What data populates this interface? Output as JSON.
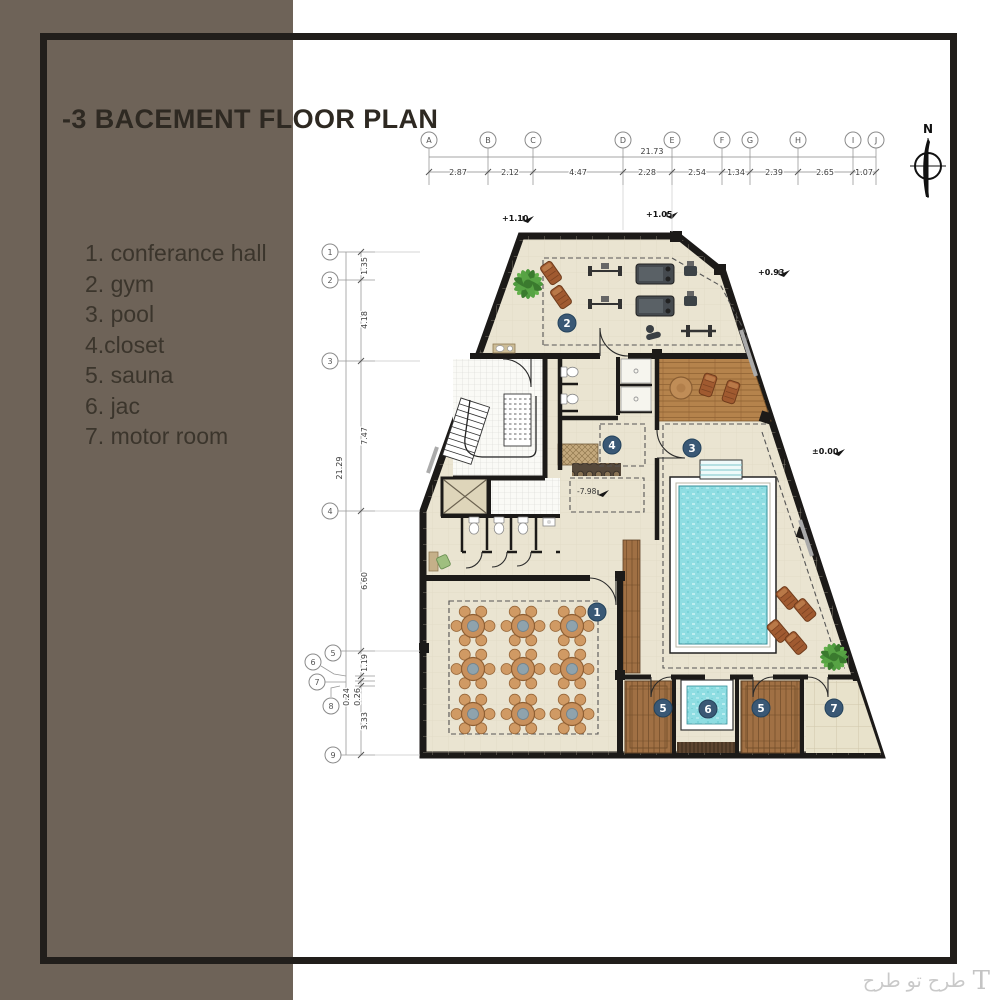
{
  "header": {
    "title": "-3 BACEMENT FLOOR PLAN"
  },
  "legend": {
    "items": [
      "1. conferance hall",
      "2. gym",
      "3. pool",
      "4.closet",
      "5. sauna",
      "6. jac",
      "7. motor room"
    ]
  },
  "plan": {
    "north_label": "N",
    "grid_top": {
      "total": "21.73",
      "letters": [
        "A",
        "B",
        "C",
        "D",
        "E",
        "F",
        "G",
        "H",
        "I",
        "J"
      ],
      "segments": [
        "2.87",
        "2.12",
        "4.47",
        "2.28",
        "2.54",
        "1.34",
        "2.39",
        "2.65",
        "1.07"
      ]
    },
    "grid_left": {
      "total": "21.29",
      "numbers": [
        "1",
        "2",
        "3",
        "4",
        "5",
        "6",
        "7",
        "8",
        "9"
      ],
      "segments": [
        "1.35",
        "4.18",
        "7.47",
        "6.60",
        "1.19",
        "0.24",
        "0.26",
        "3.33"
      ]
    },
    "elevations": {
      "top_left": "+1.10",
      "top_mid": "+1.05",
      "right": "+0.93",
      "pool_deck": "±0.00",
      "inner": "-7.98"
    },
    "badges": {
      "conference": "1",
      "gym": "2",
      "pool": "3",
      "closet": "4",
      "sauna_a": "5",
      "jac": "6",
      "sauna_b": "5",
      "motor": "7"
    }
  },
  "watermark": {
    "logo": "T",
    "text": "طرح تو طرح"
  },
  "colors": {
    "panel": "#6e6358",
    "frame": "#211e1b",
    "wall": "#1c1a18",
    "floor": "#eae4d1",
    "wood_deck": "#b5834c",
    "wood_sauna": "#a07044",
    "water": "#8edde2",
    "badge": "#3a5875"
  }
}
